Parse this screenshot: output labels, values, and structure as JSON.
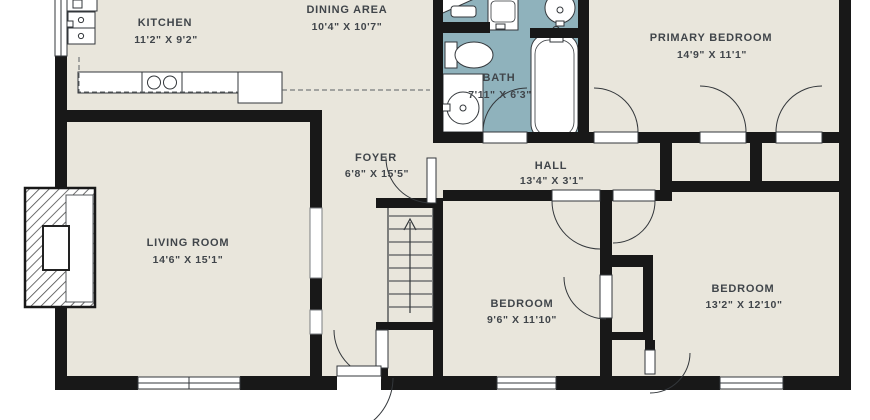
{
  "colors": {
    "floor": "#e9e6dc",
    "bath_floor": "#8fb2bc",
    "wall": "#181818",
    "fixture_line": "#33373b",
    "text": "#40454a"
  },
  "rooms": {
    "kitchen": {
      "name": "KITCHEN",
      "dims": "11'2\" X 9'2\""
    },
    "dining": {
      "name": "DINING AREA",
      "dims": "10'4\" X 10'7\""
    },
    "bath": {
      "name": "BATH",
      "dims": "7'11\" X 6'3\""
    },
    "primary": {
      "name": "PRIMARY BEDROOM",
      "dims": "14'9\" X 11'1\""
    },
    "foyer": {
      "name": "FOYER",
      "dims": "6'8\" X 15'5\""
    },
    "hall": {
      "name": "HALL",
      "dims": "13'4\" X 3'1\""
    },
    "living": {
      "name": "LIVING ROOM",
      "dims": "14'6\" X 15'1\""
    },
    "bedroom_mid": {
      "name": "BEDROOM",
      "dims": "9'6\" X 11'10\""
    },
    "bedroom_right": {
      "name": "BEDROOM",
      "dims": "13'2\" X 12'10\""
    }
  },
  "fixtures": {
    "kitchen": [
      "wall-oven-stack",
      "counter-run",
      "cooktop-two-burners",
      "upper-cabinets-dashed"
    ],
    "bath": [
      "toilet",
      "vanity-round-sink",
      "bathtub"
    ],
    "utility_top": [
      "corner-shower",
      "toilet-top",
      "washer",
      "round-basin"
    ],
    "living": [
      "fireplace-chimney",
      "hearth"
    ],
    "circulation": [
      "staircase-with-up-arrow",
      "front-door-swing",
      "door-swings",
      "windows"
    ]
  }
}
